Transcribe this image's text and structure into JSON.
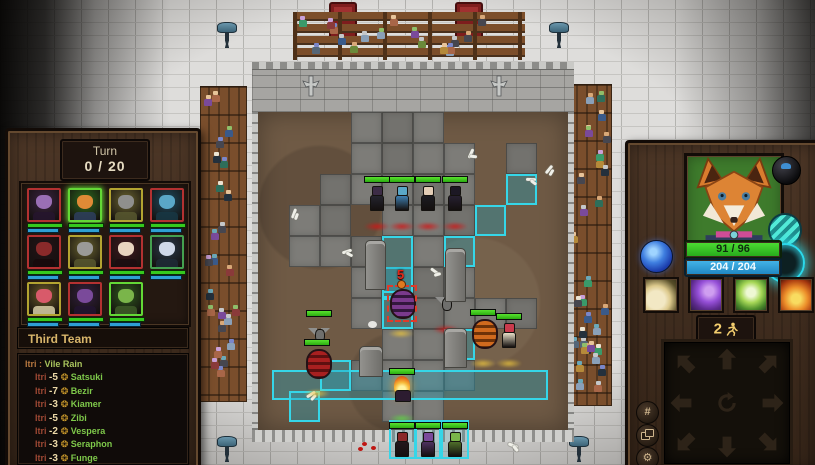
{
  "turn": {
    "label": "Turn",
    "value": "0 / 20"
  },
  "team": {
    "header": "Third Team"
  },
  "log": {
    "title": {
      "source": "Itri",
      "separator": ":",
      "text": "Vile Rain"
    },
    "entries": [
      {
        "source": "Itri",
        "amount": "-5",
        "target": "Satsuki"
      },
      {
        "source": "Itri",
        "amount": "-7",
        "target": "Bezir"
      },
      {
        "source": "Itri",
        "amount": "-3",
        "target": "Kiamer"
      },
      {
        "source": "Itri",
        "amount": "-5",
        "target": "Zibi"
      },
      {
        "source": "Itri",
        "amount": "-2",
        "target": "Vespera"
      },
      {
        "source": "Itri",
        "amount": "-3",
        "target": "Seraphon"
      },
      {
        "source": "Itri",
        "amount": "-3",
        "target": "Funge"
      }
    ],
    "gear_glyph": "❂"
  },
  "roster": [
    {
      "kind": "vampire",
      "border": "#b33131",
      "bg": "#3a2340",
      "face": "#9a6fb5",
      "torso": "#26152e"
    },
    {
      "kind": "fox",
      "border": "#63d836",
      "bg": "#2e6b1e",
      "face": "#e08a36",
      "torso": "#2e3e5e",
      "selected": true
    },
    {
      "kind": "bat",
      "border": "#b3a431",
      "bg": "#6a6430",
      "face": "#8f8f8d",
      "torso": "#57572f"
    },
    {
      "kind": "siren",
      "border": "#b33131",
      "bg": "#1e4a5e",
      "face": "#5aa7c7",
      "torso": "#173744"
    },
    {
      "kind": "red-hood",
      "border": "#b33131",
      "bg": "#241317",
      "face": "#8a2a2a",
      "torso": "#17090c"
    },
    {
      "kind": "bat",
      "border": "#b3a431",
      "bg": "#6a6430",
      "face": "#9a9a98",
      "torso": "#57572f"
    },
    {
      "kind": "dark-lady",
      "border": "#b33131",
      "bg": "#401a20",
      "face": "#e8d5c0",
      "torso": "#1c0d10"
    },
    {
      "kind": "pale-lord",
      "border": "#44a04f",
      "bg": "#2a3a4a",
      "face": "#cfd8e8",
      "torso": "#1e2a36"
    },
    {
      "kind": "mushroom",
      "border": "#b3a431",
      "bg": "#6a5a28",
      "face": "#d85a6a",
      "torso": "#d8cfa8"
    },
    {
      "kind": "imp",
      "border": "#b33131",
      "bg": "#33203f",
      "face": "#7a4a9a",
      "torso": "#221430"
    },
    {
      "kind": "orc",
      "border": "#63d836",
      "bg": "#2e5a1e",
      "face": "#7ab54a",
      "torso": "#3e5a28"
    }
  ],
  "hero": {
    "health": "91 / 96",
    "mana": "204 / 204",
    "moves": "2"
  },
  "abilities": [
    {
      "name": "wing-strike"
    },
    {
      "name": "purple-axe"
    },
    {
      "name": "green-orb"
    },
    {
      "name": "ember-burst"
    }
  ],
  "utility": {
    "grid_glyph": "#",
    "gear_glyph": "⚙"
  },
  "arena": {
    "damage_marker": "5",
    "stone_cells": [
      [
        3,
        0
      ],
      [
        4,
        0
      ],
      [
        5,
        0
      ],
      [
        3,
        1
      ],
      [
        4,
        1
      ],
      [
        5,
        1
      ],
      [
        6,
        1
      ],
      [
        2,
        2
      ],
      [
        3,
        2
      ],
      [
        4,
        2
      ],
      [
        5,
        2
      ],
      [
        6,
        2
      ],
      [
        1,
        3
      ],
      [
        2,
        3
      ],
      [
        4,
        3
      ],
      [
        5,
        3
      ],
      [
        6,
        3
      ],
      [
        1,
        4
      ],
      [
        2,
        4
      ],
      [
        3,
        4
      ],
      [
        5,
        4
      ],
      [
        3,
        5
      ],
      [
        5,
        5
      ],
      [
        6,
        5
      ],
      [
        3,
        6
      ],
      [
        5,
        6
      ],
      [
        6,
        6
      ],
      [
        7,
        6
      ],
      [
        8,
        6
      ],
      [
        4,
        7
      ],
      [
        5,
        7
      ],
      [
        3,
        8
      ],
      [
        4,
        8
      ],
      [
        5,
        8
      ],
      [
        6,
        8
      ],
      [
        4,
        9
      ],
      [
        5,
        9
      ],
      [
        8,
        1
      ]
    ],
    "highlight_cells": [
      [
        8,
        2
      ],
      [
        7,
        3
      ],
      [
        6,
        4
      ],
      [
        4,
        5
      ],
      [
        4,
        6
      ],
      [
        6,
        7
      ],
      [
        2,
        8
      ],
      [
        1,
        9
      ]
    ],
    "selected_cell": [
      4,
      4
    ],
    "band": {
      "x": 14,
      "y": 258,
      "w": 276,
      "h": 30
    },
    "unit_boxes": [
      [
        131,
        308,
        27,
        39
      ],
      [
        157,
        308,
        26,
        39
      ],
      [
        183,
        308,
        28,
        39
      ]
    ],
    "units": [
      {
        "kind": "shadow-imp",
        "shape": "humanoid",
        "x": 119,
        "y": 96,
        "hp": true,
        "glow": "red",
        "body": "#24242e",
        "head": "#3c2c46"
      },
      {
        "kind": "siren",
        "shape": "humanoid",
        "x": 144,
        "y": 96,
        "hp": true,
        "glow": "red",
        "body": "#3f7fb0",
        "head": "#5aa7c7"
      },
      {
        "kind": "dark-lady",
        "shape": "humanoid",
        "x": 170,
        "y": 96,
        "hp": true,
        "glow": "red",
        "body": "#1c1c22",
        "head": "#e3cdb6"
      },
      {
        "kind": "shadow-cat",
        "shape": "humanoid",
        "x": 197,
        "y": 96,
        "hp": true,
        "glow": "red",
        "body": "#262030",
        "head": "#1c1824"
      },
      {
        "kind": "gray-bat",
        "shape": "bat",
        "x": 61,
        "y": 230,
        "hp": true,
        "glow": "gold",
        "body": "#8f8f8d",
        "head": "#6f6f6d"
      },
      {
        "kind": "red-egg",
        "shape": "barrel",
        "x": 59,
        "y": 263,
        "hp": true,
        "glow": "gold",
        "body": "#a82020",
        "head": "#5e1010"
      },
      {
        "kind": "purple-egg",
        "shape": "barrel",
        "x": 143,
        "y": 203,
        "hp": false,
        "glow": "gold",
        "body": "#7a3a8c",
        "head": "#33173d",
        "selected": true
      },
      {
        "kind": "gray-bat",
        "shape": "bat",
        "x": 188,
        "y": 199,
        "hp": false,
        "glow": "red",
        "body": "#8f8f8d",
        "head": "#6f6f6d"
      },
      {
        "kind": "orange-barrel",
        "shape": "barrel",
        "x": 225,
        "y": 233,
        "hp": true,
        "glow": "gold",
        "body": "#d06a1e",
        "head": "#6e3208"
      },
      {
        "kind": "mushroom-girl",
        "shape": "humanoid",
        "x": 251,
        "y": 233,
        "hp": true,
        "glow": "gold",
        "body": "#e8dfc8",
        "head": "#c93a4c"
      },
      {
        "kind": "flame-spirit",
        "shape": "flame",
        "x": 144,
        "y": 288,
        "hp": true,
        "glow": "green"
      },
      {
        "kind": "red-hood",
        "shape": "humanoid",
        "x": 144,
        "y": 342,
        "hp": true,
        "glow": "green",
        "body": "#23181c",
        "head": "#8a2a2a"
      },
      {
        "kind": "purple-imp",
        "shape": "humanoid",
        "x": 170,
        "y": 342,
        "hp": true,
        "glow": "green",
        "body": "#4e3260",
        "head": "#7a4a9a"
      },
      {
        "kind": "green-orc",
        "shape": "humanoid",
        "x": 197,
        "y": 342,
        "hp": true,
        "glow": "green",
        "body": "#4e6e2a",
        "head": "#7ab54a"
      },
      {
        "kind": "statue",
        "shape": "statue",
        "x": 116,
        "y": 176,
        "w": 19,
        "h": 48
      },
      {
        "kind": "statue",
        "shape": "statue",
        "x": 196,
        "y": 188,
        "w": 19,
        "h": 52
      },
      {
        "kind": "gravestone",
        "shape": "statue",
        "x": 196,
        "y": 254,
        "w": 21,
        "h": 38
      },
      {
        "kind": "gravestone",
        "shape": "statue",
        "x": 112,
        "y": 263,
        "w": 22,
        "h": 29
      }
    ],
    "bones": [
      [
        31,
        100
      ],
      [
        84,
        138
      ],
      [
        172,
        158
      ],
      [
        286,
        56
      ],
      [
        268,
        66
      ],
      [
        246,
        218
      ],
      [
        48,
        281
      ],
      [
        250,
        332
      ],
      [
        208,
        40
      ]
    ],
    "blood": [
      [
        104,
        330
      ],
      [
        113,
        334
      ],
      [
        100,
        335
      ]
    ],
    "puff": [
      [
        110,
        209
      ]
    ]
  },
  "crowd": {
    "skin": [
      "#e8c49a",
      "#d8a878",
      "#c5c7c9",
      "#8fbf6a",
      "#7a86c9",
      "#ece4d2",
      "#6aa8b8",
      "#caa0d8"
    ],
    "body": [
      "#3a5a8a",
      "#6a8a3a",
      "#7a4a9a",
      "#8a3a3a",
      "#46464f",
      "#2e6e5a",
      "#b58a3a",
      "#556677",
      "#3a9a6a",
      "#a86648",
      "#24303c",
      "#8aa0b8"
    ],
    "fence_count": 17,
    "left_count": 24,
    "right_count": 34
  },
  "colors": {
    "accent_cyan": "#35d6e8",
    "hp_green": "#3ece1e",
    "mana_blue": "#2e9fd4"
  }
}
